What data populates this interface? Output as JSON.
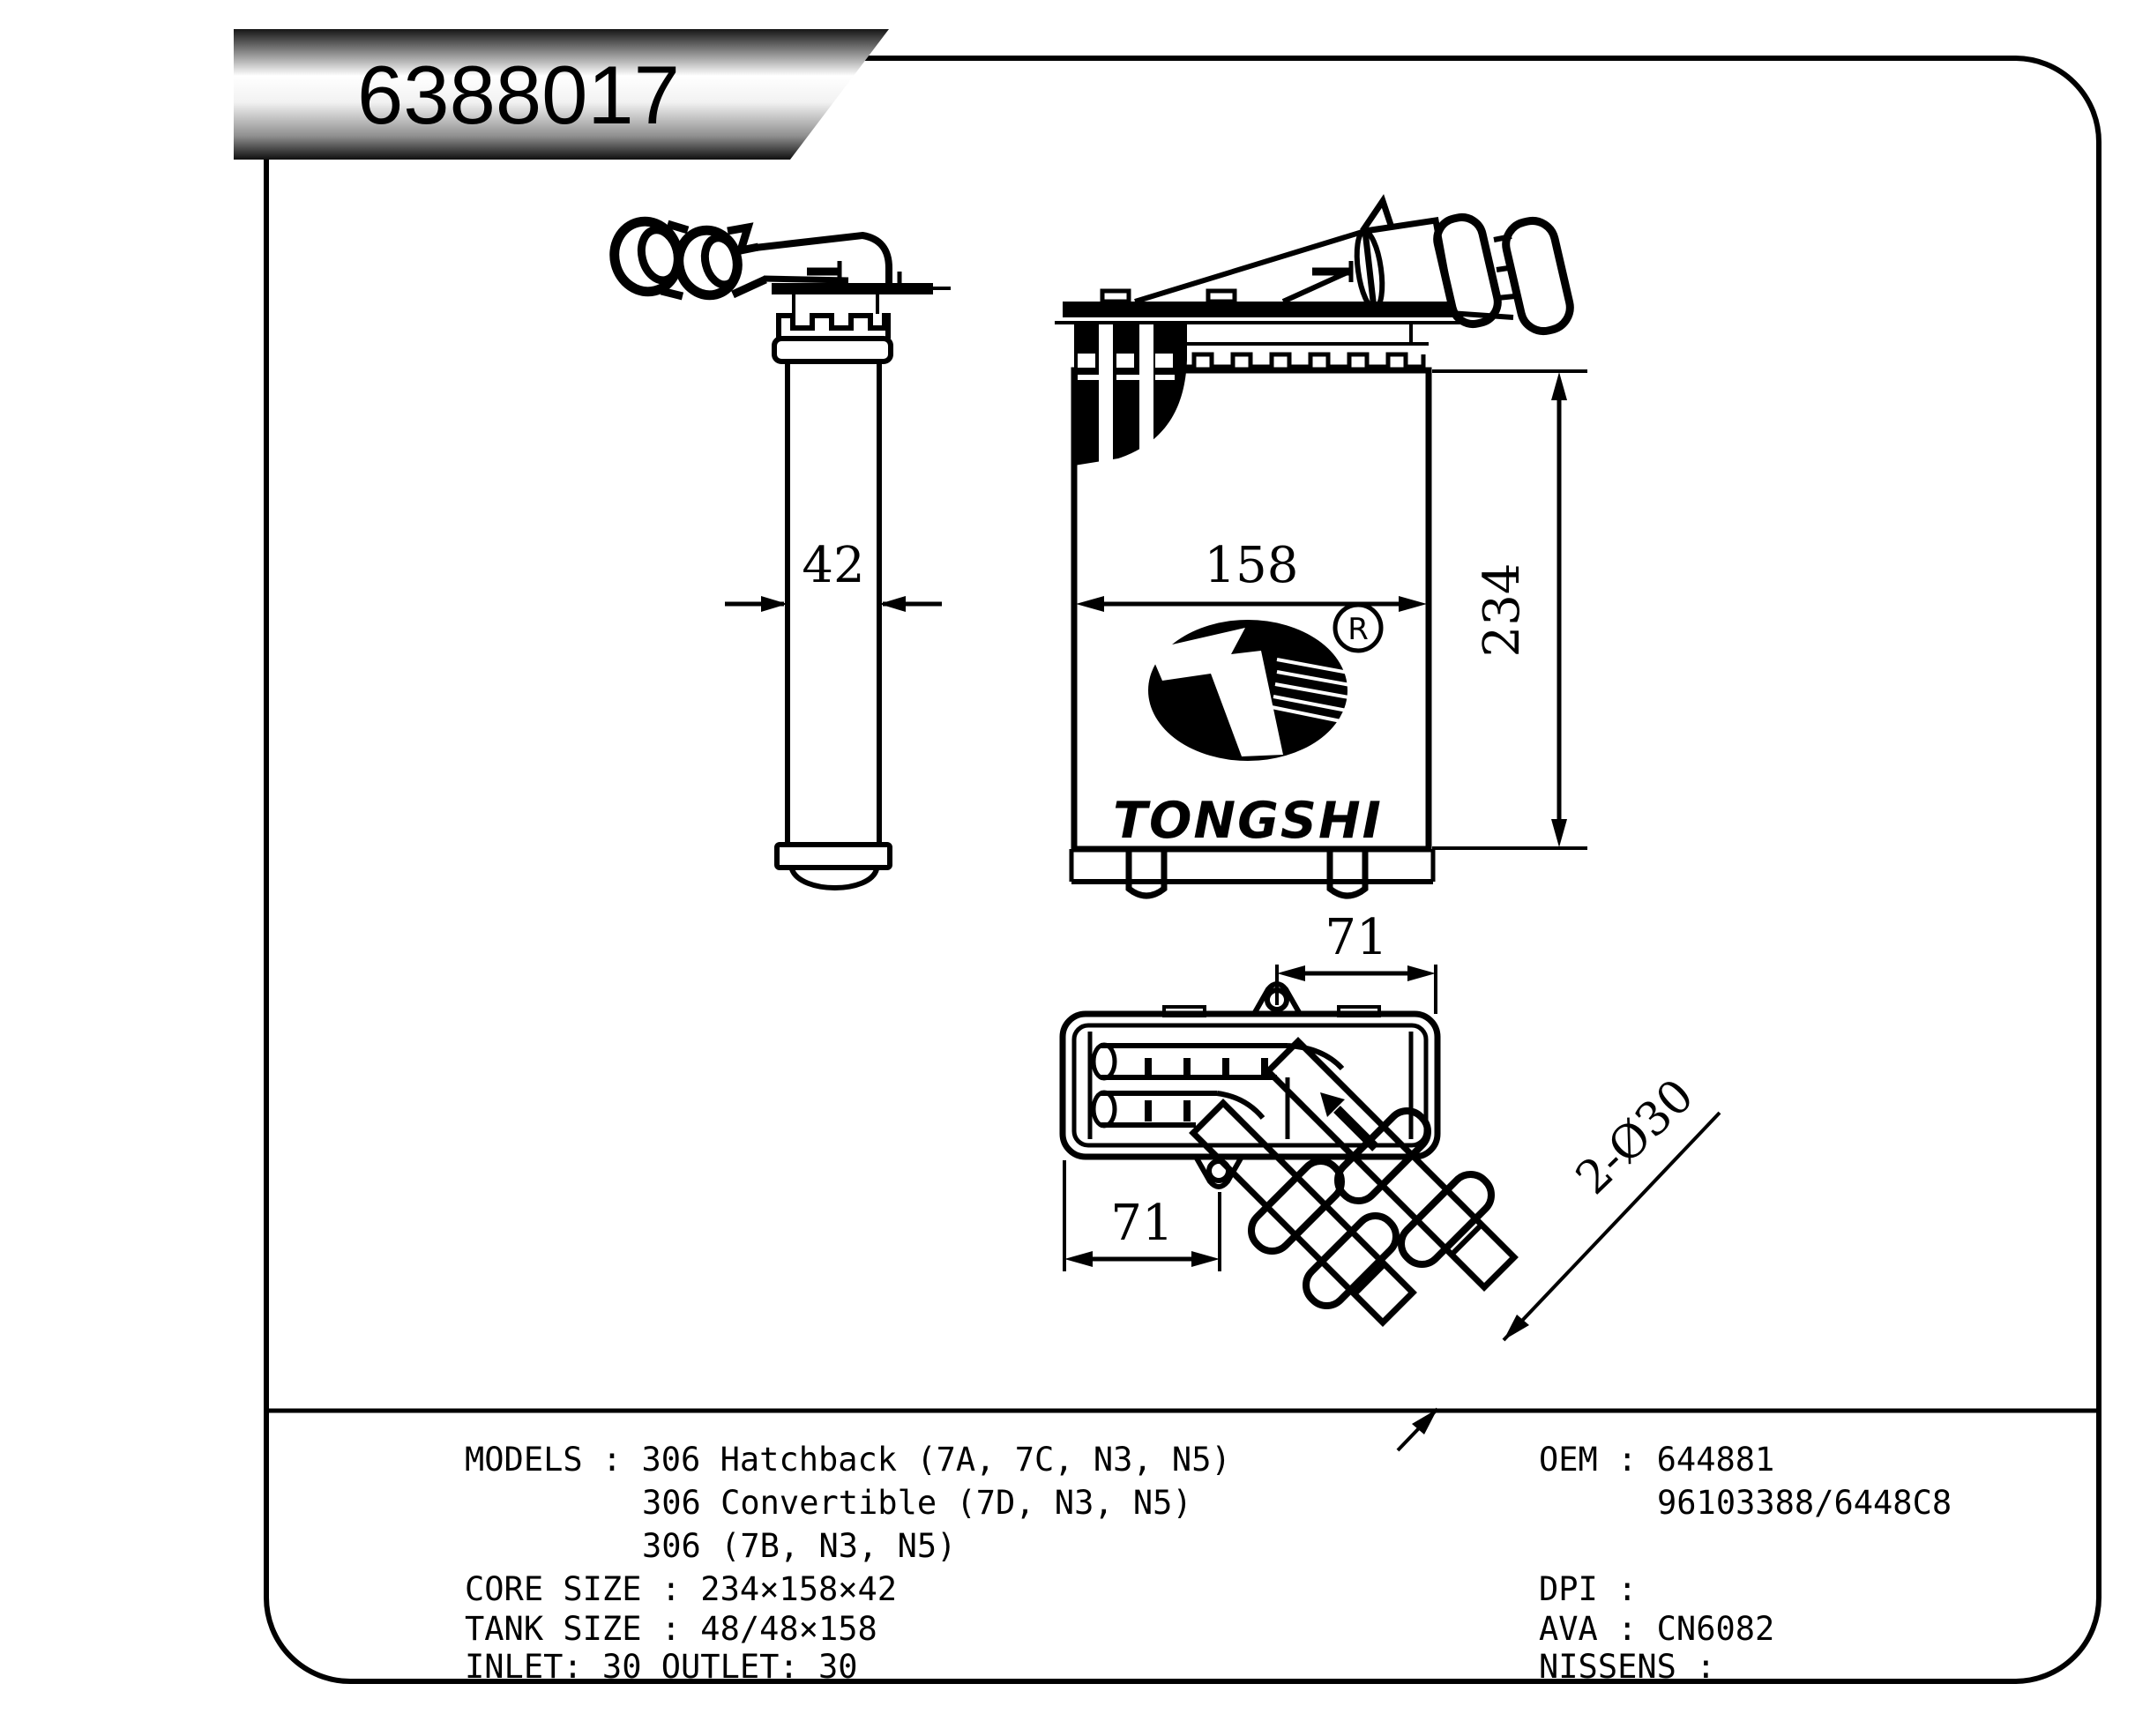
{
  "title_banner": {
    "part_number": "6388017"
  },
  "logo": {
    "brand": "TONGSHI",
    "registered_letter": "R"
  },
  "dimensions": {
    "side_width": "42",
    "front_width": "158",
    "front_height": "234",
    "tank_top_offset": "71",
    "tank_bottom_offset": "71",
    "pipes_diameter": "2-Ø30"
  },
  "info": {
    "left": [
      "MODELS : 306 Hatchback (7A, 7C, N3, N5)",
      "306 Convertible (7D, N3, N5)",
      "306 (7B, N3, N5)",
      "CORE SIZE : 234×158×42",
      "TANK SIZE : 48/48×158",
      "INLET: 30 OUTLET: 30"
    ],
    "right": [
      "OEM : 644881",
      "96103388/6448C8",
      "DPI :",
      "AVA : CN6082",
      "NISSENS :"
    ]
  },
  "colors": {
    "line": "#000000",
    "background": "#ffffff"
  }
}
